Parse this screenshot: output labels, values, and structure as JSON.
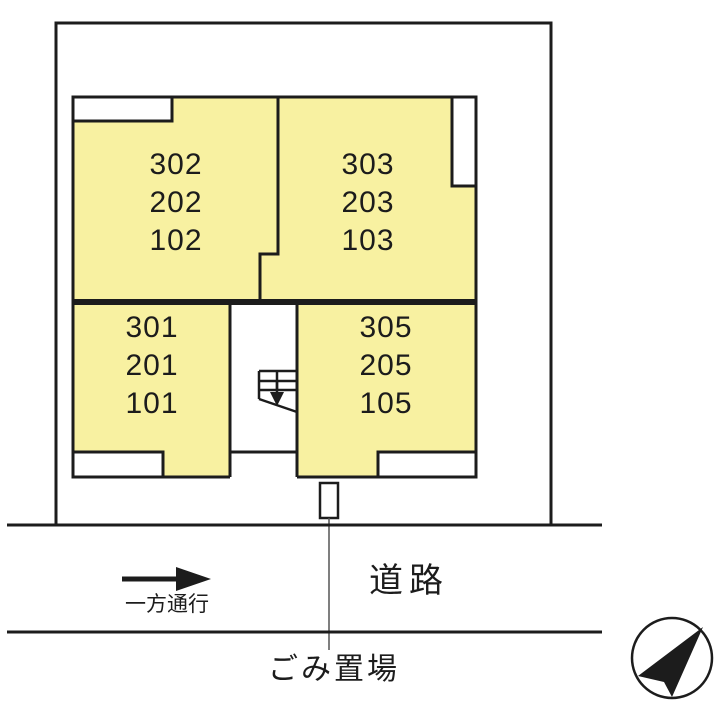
{
  "plan": {
    "rooms": [
      {
        "id": "room-302",
        "units": [
          "302",
          "202",
          "102"
        ]
      },
      {
        "id": "room-303",
        "units": [
          "303",
          "203",
          "103"
        ]
      },
      {
        "id": "room-301",
        "units": [
          "301",
          "201",
          "101"
        ]
      },
      {
        "id": "room-305",
        "units": [
          "305",
          "205",
          "105"
        ]
      }
    ],
    "stair_icon": "staircase-down-arrow-icon",
    "compass_icon": "north-arrow-icon"
  },
  "road": {
    "label": "道路",
    "one_way_label": "一方通行"
  },
  "garbage": {
    "label": "ごみ置場"
  },
  "colors": {
    "room_fill": "#F8F1A1",
    "line": "#1C1C1C",
    "background": "#FFFFFF"
  }
}
